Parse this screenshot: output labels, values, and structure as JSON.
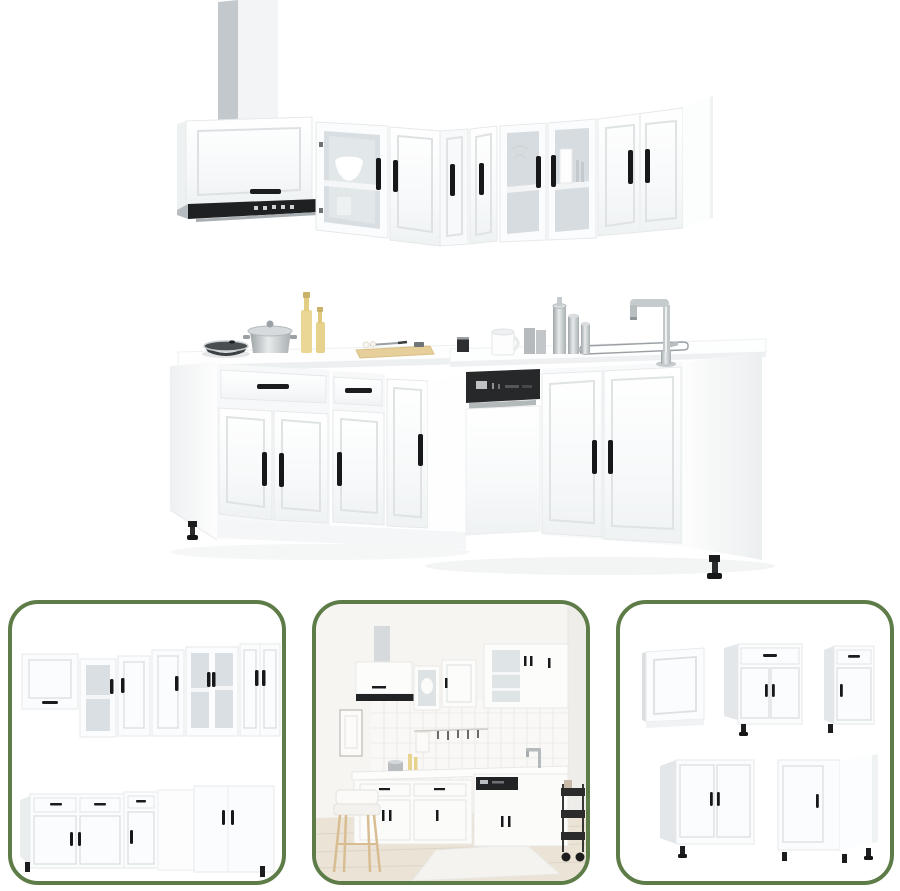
{
  "gallery": {
    "main_image": {
      "label": "White high-gloss L-shaped kitchen cabinet set with wall units, glass doors, range hood, dishwasher and sink faucet"
    },
    "thumbnails": [
      {
        "label": "Kitchen cabinet set viewed from opposite angle"
      },
      {
        "label": "Kitchen cabinet set installed in room scene with bar stool and serving cart"
      },
      {
        "label": "Individual cabinet units: end panel, drawer base cabinets, sink base cabinet and corner base cabinet"
      }
    ]
  },
  "palette": {
    "background": "#ffffff",
    "cabinet_white": "#fafbfc",
    "cabinet_line": "#e6e9ea",
    "panel_line": "#dde1e3",
    "side_gray": "#d9dee0",
    "glass_gray": "#d8dee1",
    "handle_black": "#1b1c1d",
    "hood_black": "#1f2021",
    "appliance_black": "#27282a",
    "chrome": "#b9bfc2",
    "oil_yellow": "#e8d48e",
    "board_tan": "#e4cc96",
    "thumb_border_green": "#5e7c48",
    "room_wall": "#f6f5f2",
    "room_floor": "#eae3d6",
    "stool_wood": "#d9bd92"
  }
}
